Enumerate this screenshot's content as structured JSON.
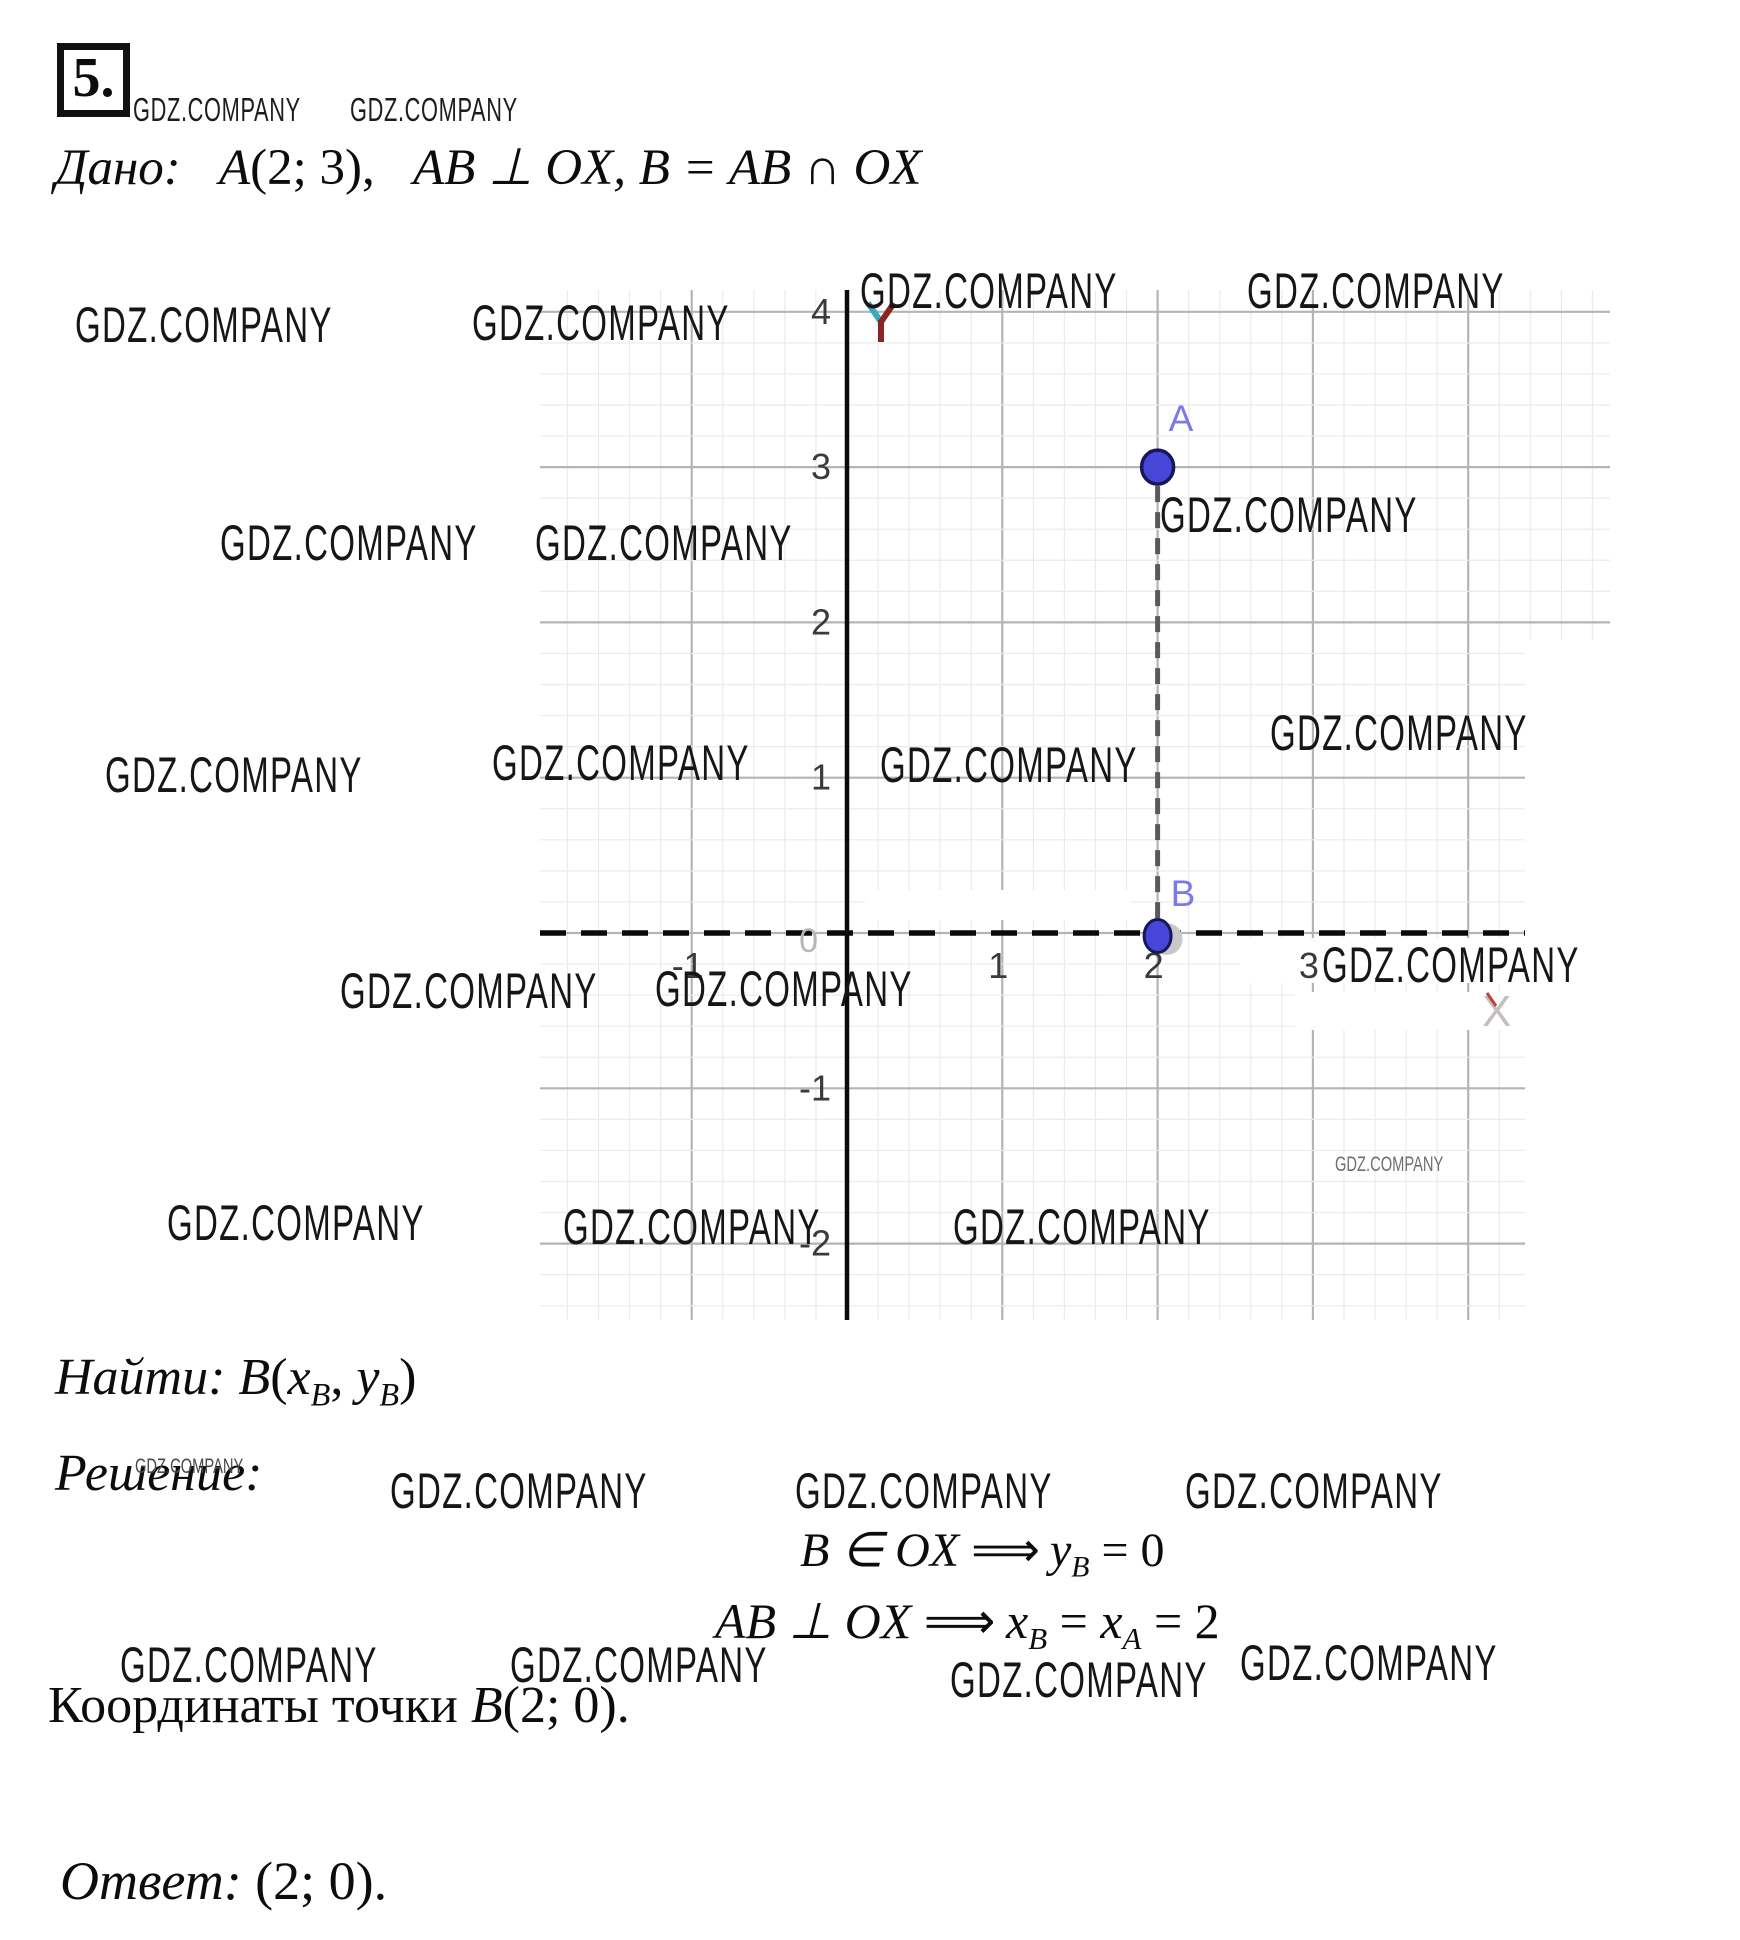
{
  "watermark_text": "GDZ.COMPANY",
  "header": {
    "problem_number": "5.",
    "given_label": "Дано:",
    "given_point": "A",
    "given_point_coords": "(2; 3),",
    "given_rest": "AB ⊥ OX, B = AB ∩ OX"
  },
  "solution": {
    "find_label": "Найти:",
    "find_point": "B",
    "find_open": "(",
    "find_x": "x",
    "find_x_sub": "B",
    "find_comma": ", ",
    "find_y": "y",
    "find_y_sub": "B",
    "find_close": ")",
    "solution_label": "Решение:",
    "eq1_lhs": "B ∈ OX",
    "eq1_arrow": "⟹",
    "eq1_var": "y",
    "eq1_var_sub": "B",
    "eq1_rhs": "= 0",
    "eq2_lhs": "AB ⊥ OX",
    "eq2_arrow": "⟹",
    "eq2_x1": "x",
    "eq2_x1_sub": "B",
    "eq2_eq1": "=",
    "eq2_x2": "x",
    "eq2_x2_sub": "A",
    "eq2_rhs": "= 2",
    "coords_prefix": "Координаты точки ",
    "coords_point": "B",
    "coords_value": "(2; 0).",
    "answer_label": "Ответ:",
    "answer_value": "(2; 0)."
  },
  "chart_data": {
    "type": "scatter",
    "title": "",
    "xlabel": "X",
    "ylabel": "Y",
    "xlim": [
      -1.95,
      4.85
    ],
    "ylim": [
      -2.45,
      4.15
    ],
    "grid": true,
    "x_ticks": [
      -1,
      1,
      2,
      3
    ],
    "y_ticks": [
      4,
      3,
      2,
      1,
      -1,
      -2
    ],
    "origin_label": "0",
    "points": [
      {
        "name": "A",
        "x": 2,
        "y": 3
      },
      {
        "name": "B",
        "x": 2,
        "y": 0
      }
    ],
    "segment": {
      "from": [
        2,
        3
      ],
      "to": [
        2,
        0
      ],
      "style": "dashed"
    },
    "colors": {
      "point_fill": "#4646d8",
      "point_stroke": "#181858",
      "point_label": "#7a7aea",
      "halo": "#c8c8c8",
      "grid_fine": "#ebebeb",
      "grid_major": "#b4b4b4",
      "axis": "#0a0a0a",
      "segment": "#5a5a5a",
      "tick_text": "#3a3a3a",
      "origin_text": "#b5b5b5",
      "x_label": "#c6bdbd",
      "y_label_left": "#3aabbe",
      "y_label_right": "#8a2525"
    },
    "layout": {
      "origin_x": 307,
      "origin_y": 643,
      "unit": 155.3,
      "fine_per_unit": 5,
      "x_axis_end": 985,
      "whiteout": [
        [
          985,
          350,
          85,
          680
        ],
        [
          325,
          600,
          265,
          30
        ],
        [
          700,
          648,
          310,
          45
        ],
        [
          755,
          702,
          265,
          38
        ]
      ]
    }
  },
  "watermarks": [
    {
      "x": 133,
      "y": 93,
      "v": "small"
    },
    {
      "x": 350,
      "y": 93,
      "v": "small"
    },
    {
      "x": 75,
      "y": 300,
      "v": "std"
    },
    {
      "x": 472,
      "y": 298,
      "v": "std"
    },
    {
      "x": 860,
      "y": 266,
      "v": "std"
    },
    {
      "x": 1247,
      "y": 266,
      "v": "std"
    },
    {
      "x": 220,
      "y": 518,
      "v": "std"
    },
    {
      "x": 535,
      "y": 518,
      "v": "std"
    },
    {
      "x": 1160,
      "y": 490,
      "v": "std"
    },
    {
      "x": 1270,
      "y": 708,
      "v": "std"
    },
    {
      "x": 105,
      "y": 750,
      "v": "std"
    },
    {
      "x": 492,
      "y": 738,
      "v": "std"
    },
    {
      "x": 880,
      "y": 740,
      "v": "std"
    },
    {
      "x": 340,
      "y": 966,
      "v": "std"
    },
    {
      "x": 655,
      "y": 964,
      "v": "std"
    },
    {
      "x": 1322,
      "y": 940,
      "v": "std"
    },
    {
      "x": 167,
      "y": 1198,
      "v": "std"
    },
    {
      "x": 563,
      "y": 1202,
      "v": "std"
    },
    {
      "x": 953,
      "y": 1202,
      "v": "std"
    },
    {
      "x": 1335,
      "y": 1154,
      "v": "tinyg"
    },
    {
      "x": 135,
      "y": 1456,
      "v": "tiny"
    },
    {
      "x": 390,
      "y": 1466,
      "v": "std"
    },
    {
      "x": 795,
      "y": 1466,
      "v": "std"
    },
    {
      "x": 1185,
      "y": 1466,
      "v": "std"
    },
    {
      "x": 120,
      "y": 1640,
      "v": "std"
    },
    {
      "x": 510,
      "y": 1640,
      "v": "std"
    },
    {
      "x": 950,
      "y": 1655,
      "v": "std"
    },
    {
      "x": 1240,
      "y": 1638,
      "v": "std"
    }
  ]
}
